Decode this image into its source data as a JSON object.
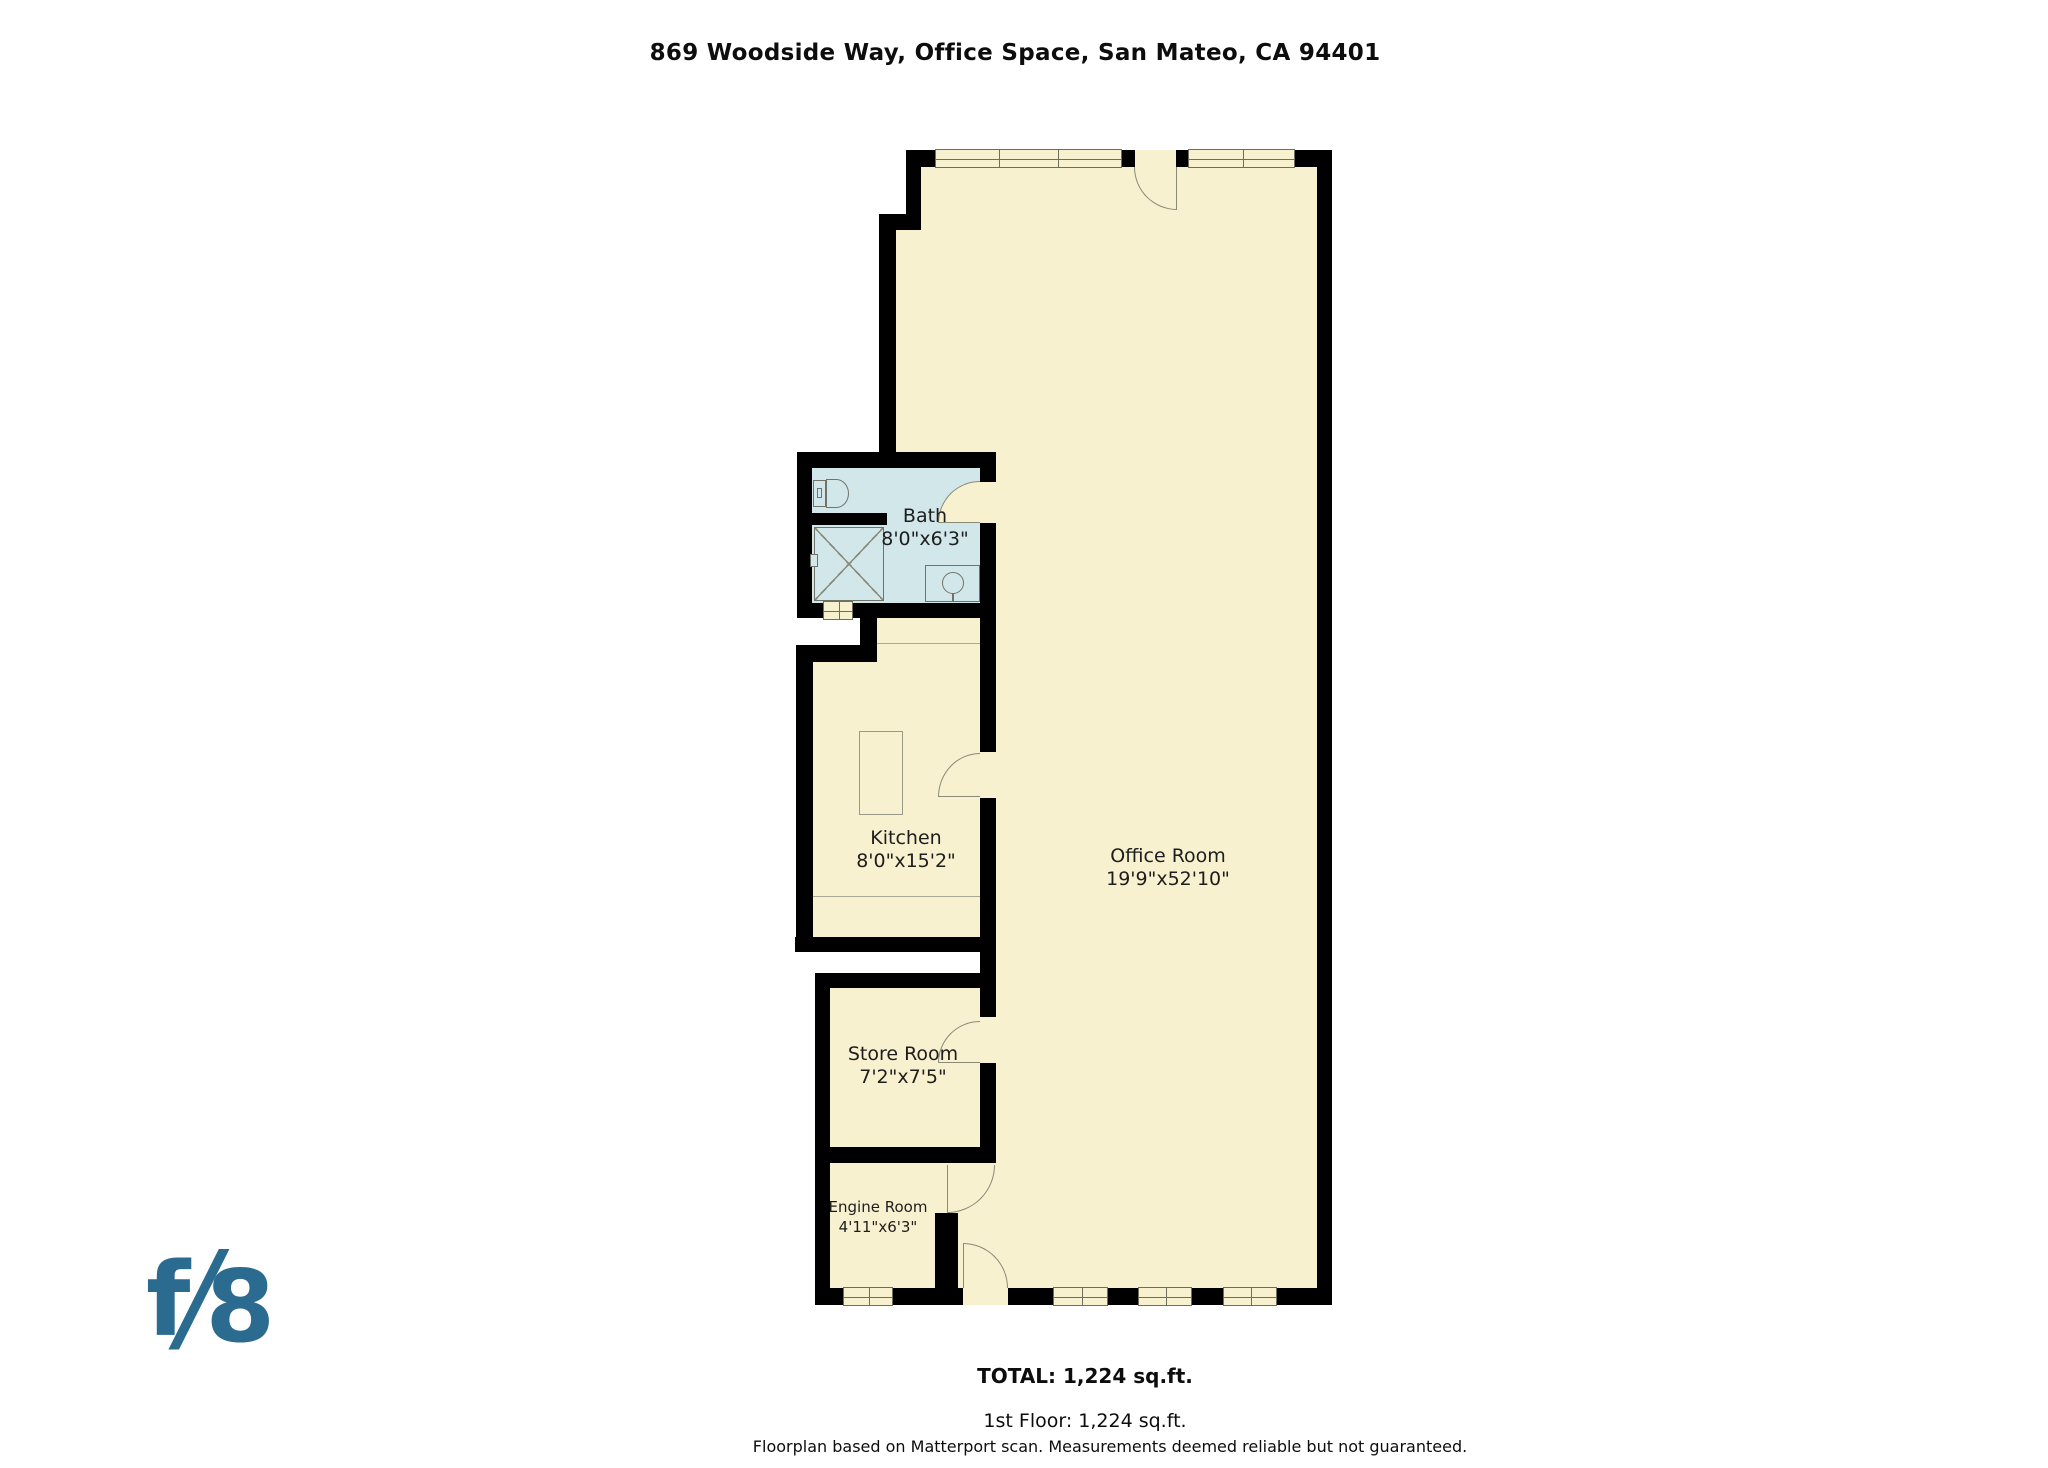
{
  "title": "869 Woodside Way, Office Space, San Mateo, CA 94401",
  "rooms": {
    "bath": {
      "name": "Bath",
      "dims": "8'0\"x6'3\""
    },
    "kitchen": {
      "name": "Kitchen",
      "dims": "8'0\"x15'2\""
    },
    "office": {
      "name": "Office Room",
      "dims": "19'9\"x52'10\""
    },
    "store": {
      "name": "Store Room",
      "dims": "7'2\"x7'5\""
    },
    "engine": {
      "name": "Engine Room",
      "dims": "4'11\"x6'3\""
    }
  },
  "summary": {
    "total": "TOTAL: 1,224 sq.ft.",
    "first_floor": "1st Floor: 1,224 sq.ft.",
    "disclaimer": "Floorplan based on Matterport scan. Measurements deemed reliable but not guaranteed."
  },
  "logo": {
    "f": "f",
    "slash": "/",
    "eight": "8",
    "color": "#2a6b8f"
  },
  "colors": {
    "floor": "#f8f1cf",
    "bath_floor": "#d2e7ea",
    "wall": "#000000",
    "fixture_line": "#8a8a7a"
  }
}
